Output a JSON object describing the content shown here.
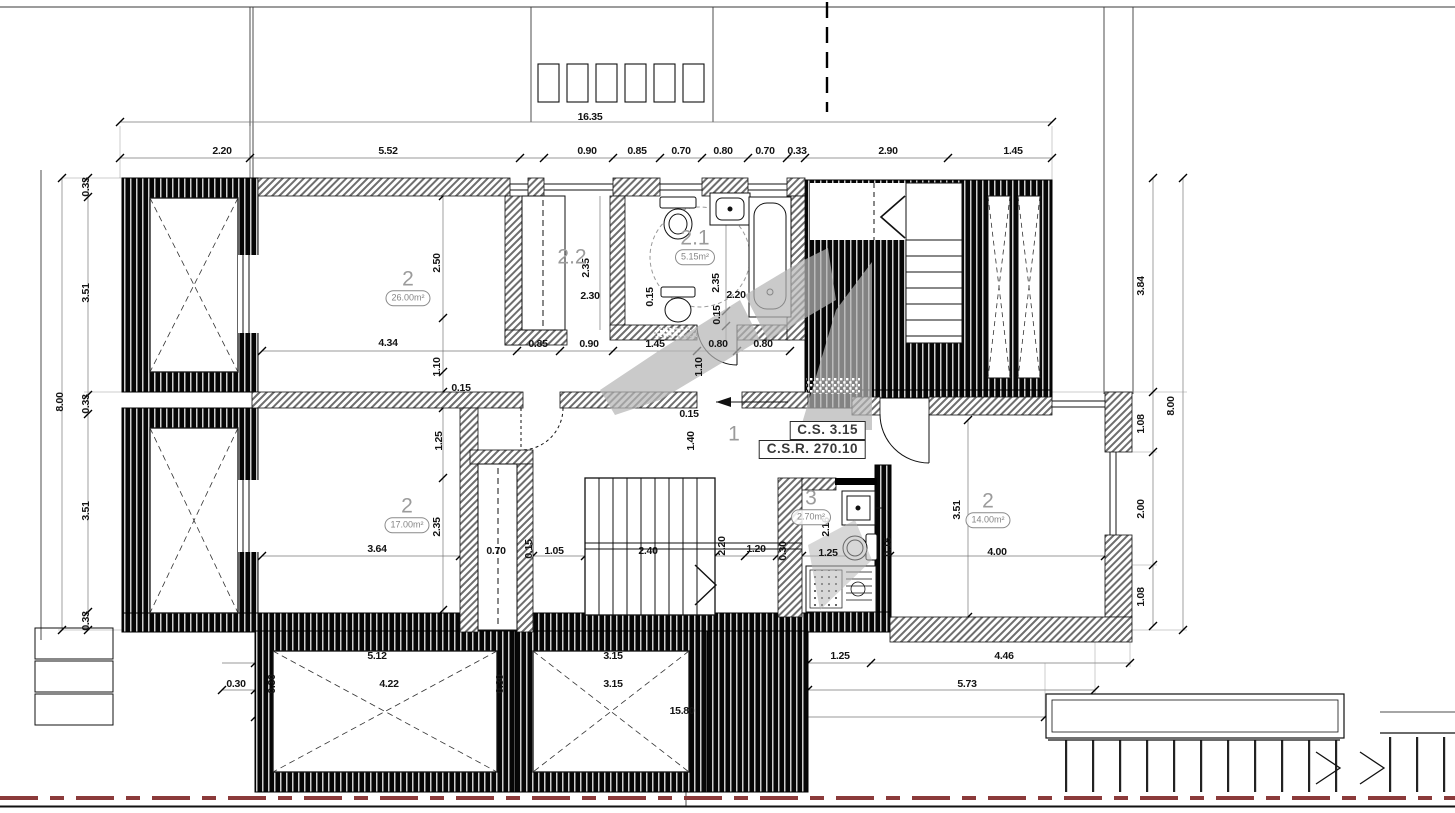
{
  "meta": {
    "drawing_type": "architectural floor plan"
  },
  "colors": {
    "boundary_red": "#8b3a3a",
    "watermark_gray": "#b5b5b5",
    "line_black": "#1a1a1a"
  },
  "info_box": {
    "line1": "C.S. 3.15",
    "line2": "C.S.R. 270.10"
  },
  "room_labels": [
    {
      "num": "2",
      "area": "26.00m²",
      "x": 408,
      "y": 287
    },
    {
      "num": "2.2",
      "area": "",
      "x": 572,
      "y": 257
    },
    {
      "num": "2.1",
      "area": "5.15m²",
      "x": 695,
      "y": 246
    },
    {
      "num": "1",
      "area": "",
      "x": 734,
      "y": 434
    },
    {
      "num": "2",
      "area": "17.00m²",
      "x": 407,
      "y": 514
    },
    {
      "num": "3",
      "area": "2.70m²",
      "x": 811,
      "y": 506
    },
    {
      "num": "2",
      "area": "14.00m²",
      "x": 988,
      "y": 509
    }
  ],
  "dimension_labels": [
    {
      "t": "16.35",
      "x": 590,
      "y": 117
    },
    {
      "t": "2.20",
      "x": 222,
      "y": 151
    },
    {
      "t": "5.52",
      "x": 388,
      "y": 151
    },
    {
      "t": "0.90",
      "x": 587,
      "y": 151
    },
    {
      "t": "0.85",
      "x": 637,
      "y": 151
    },
    {
      "t": "0.70",
      "x": 681,
      "y": 151
    },
    {
      "t": "0.80",
      "x": 723,
      "y": 151
    },
    {
      "t": "0.70",
      "x": 765,
      "y": 151
    },
    {
      "t": "0.33",
      "x": 797,
      "y": 151
    },
    {
      "t": "2.90",
      "x": 888,
      "y": 151
    },
    {
      "t": "1.45",
      "x": 1013,
      "y": 151
    },
    {
      "t": "8.00",
      "x": 60,
      "y": 402,
      "r": 1
    },
    {
      "t": "0.33",
      "x": 86,
      "y": 187,
      "r": 1
    },
    {
      "t": "3.51",
      "x": 86,
      "y": 293,
      "r": 1
    },
    {
      "t": "0.33",
      "x": 86,
      "y": 404,
      "r": 1
    },
    {
      "t": "3.51",
      "x": 86,
      "y": 511,
      "r": 1
    },
    {
      "t": "0.33",
      "x": 86,
      "y": 621,
      "r": 1
    },
    {
      "t": "3.84",
      "x": 1141,
      "y": 286,
      "r": 1
    },
    {
      "t": "1.08",
      "x": 1141,
      "y": 424,
      "r": 1
    },
    {
      "t": "2.00",
      "x": 1141,
      "y": 509,
      "r": 1
    },
    {
      "t": "1.08",
      "x": 1141,
      "y": 597,
      "r": 1
    },
    {
      "t": "8.00",
      "x": 1171,
      "y": 406,
      "r": 1
    },
    {
      "t": "2.50",
      "x": 437,
      "y": 263,
      "r": 1
    },
    {
      "t": "4.34",
      "x": 388,
      "y": 343
    },
    {
      "t": "1.10",
      "x": 437,
      "y": 367,
      "r": 1
    },
    {
      "t": "0.15",
      "x": 461,
      "y": 388
    },
    {
      "t": "0.85",
      "x": 538,
      "y": 344
    },
    {
      "t": "0.90",
      "x": 589,
      "y": 344
    },
    {
      "t": "1.45",
      "x": 655,
      "y": 344
    },
    {
      "t": "0.80",
      "x": 718,
      "y": 344
    },
    {
      "t": "0.80",
      "x": 763,
      "y": 344
    },
    {
      "t": "2.35",
      "x": 586,
      "y": 268,
      "r": 1
    },
    {
      "t": "2.30",
      "x": 590,
      "y": 296
    },
    {
      "t": "0.15",
      "x": 650,
      "y": 297,
      "r": 1
    },
    {
      "t": "2.35",
      "x": 716,
      "y": 283,
      "r": 1
    },
    {
      "t": "2.20",
      "x": 736,
      "y": 295
    },
    {
      "t": "0.15",
      "x": 717,
      "y": 315,
      "r": 1
    },
    {
      "t": "1.10",
      "x": 699,
      "y": 367,
      "r": 1
    },
    {
      "t": "0.15",
      "x": 689,
      "y": 414
    },
    {
      "t": "1.40",
      "x": 691,
      "y": 441,
      "r": 1
    },
    {
      "t": "1.25",
      "x": 439,
      "y": 441,
      "r": 1
    },
    {
      "t": "2.35",
      "x": 437,
      "y": 527,
      "r": 1
    },
    {
      "t": "3.64",
      "x": 377,
      "y": 549
    },
    {
      "t": "0.70",
      "x": 496,
      "y": 551
    },
    {
      "t": "0.15",
      "x": 529,
      "y": 549,
      "r": 1
    },
    {
      "t": "1.05",
      "x": 554,
      "y": 551
    },
    {
      "t": "2.40",
      "x": 648,
      "y": 551
    },
    {
      "t": "2.20",
      "x": 722,
      "y": 546,
      "r": 1
    },
    {
      "t": "1.20",
      "x": 756,
      "y": 549
    },
    {
      "t": "0.30",
      "x": 783,
      "y": 551,
      "r": 1
    },
    {
      "t": "2.16",
      "x": 826,
      "y": 527,
      "r": 1
    },
    {
      "t": "1.25",
      "x": 828,
      "y": 553
    },
    {
      "t": "0.15",
      "x": 888,
      "y": 547,
      "r": 1
    },
    {
      "t": "3.51",
      "x": 957,
      "y": 510,
      "r": 1
    },
    {
      "t": "4.00",
      "x": 997,
      "y": 552
    },
    {
      "t": "5.12",
      "x": 377,
      "y": 656
    },
    {
      "t": "3.15",
      "x": 613,
      "y": 656
    },
    {
      "t": "1.25",
      "x": 840,
      "y": 656
    },
    {
      "t": "4.46",
      "x": 1004,
      "y": 656
    },
    {
      "t": "0.30",
      "x": 236,
      "y": 684
    },
    {
      "t": "0.30",
      "x": 272,
      "y": 684,
      "r": 1
    },
    {
      "t": "4.22",
      "x": 389,
      "y": 684
    },
    {
      "t": "0.30",
      "x": 500,
      "y": 684,
      "r": 1
    },
    {
      "t": "3.15",
      "x": 613,
      "y": 684
    },
    {
      "t": "5.73",
      "x": 967,
      "y": 684
    },
    {
      "t": "15.80",
      "x": 682,
      "y": 711
    }
  ]
}
